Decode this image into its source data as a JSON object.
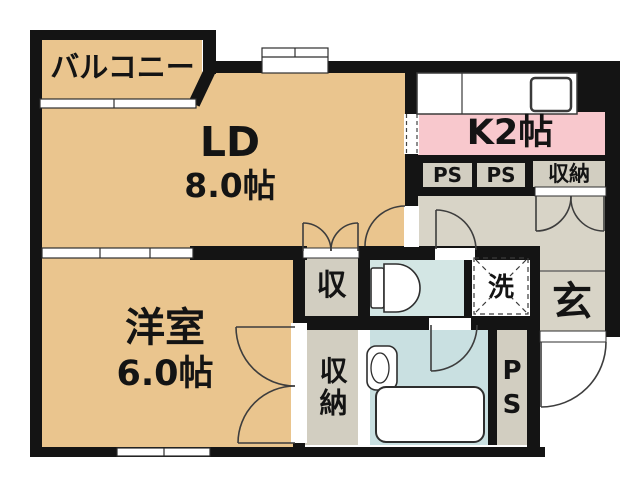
{
  "plan": {
    "balcony": {
      "label": "バルコニー"
    },
    "living_dining": {
      "label": "LD",
      "size": "8.0帖"
    },
    "kitchen": {
      "label": "K2帖"
    },
    "western_room": {
      "label": "洋室",
      "size": "6.0帖"
    },
    "pipe_space_1": {
      "label": "PS"
    },
    "pipe_space_2": {
      "label": "PS"
    },
    "hall_storage": {
      "label": "収納"
    },
    "closet_upper": {
      "label": "収"
    },
    "closet_lower": {
      "label": "収納"
    },
    "washer_space": {
      "label": "洗"
    },
    "entrance": {
      "label": "玄"
    },
    "pipe_shaft": {
      "label": "PS"
    }
  },
  "colors": {
    "room_tan": "#eac58e",
    "kitchen_pink": "#f8c8cd",
    "wet_area_blue": "#d3e6e4",
    "bath_blue": "#c9e0e1",
    "floor_gray": "#d8d4c7",
    "service_gray": "#d2cec1",
    "wall_black": "#141414",
    "background": "#ffffff"
  }
}
